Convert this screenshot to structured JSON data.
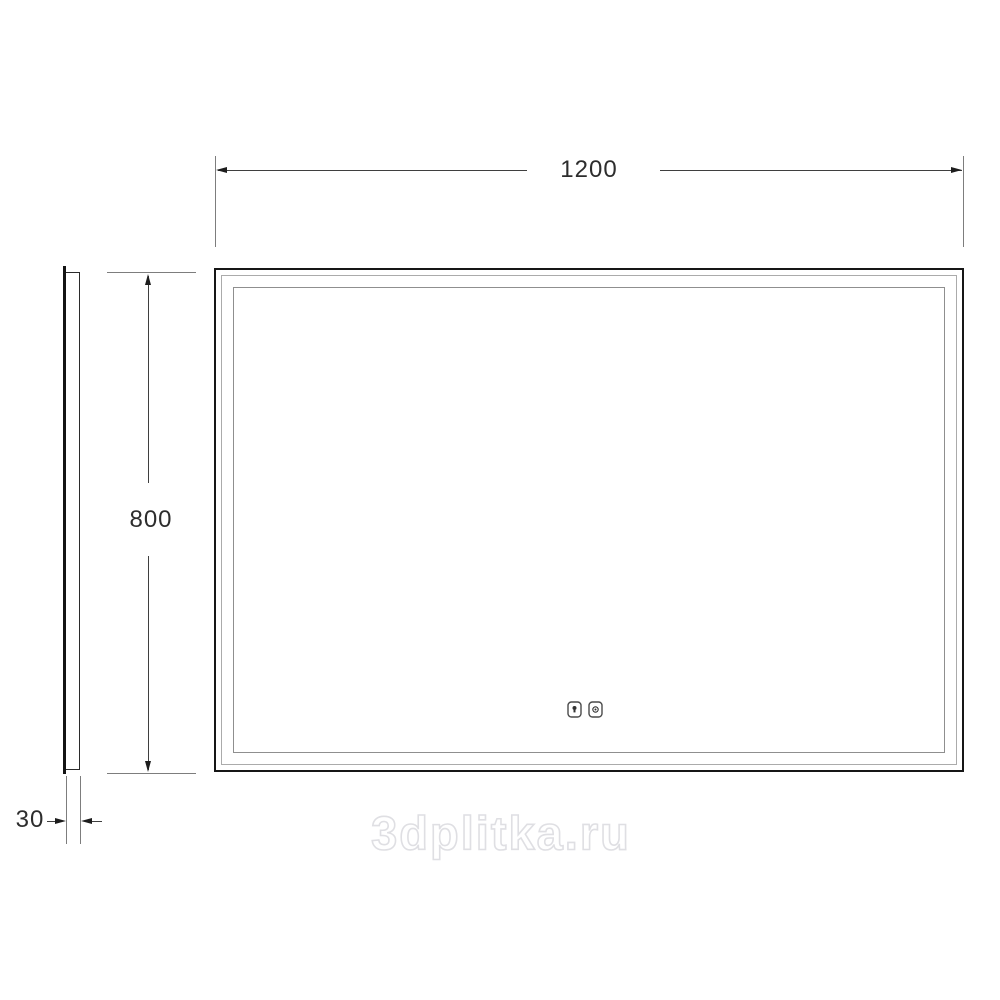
{
  "drawing": {
    "kind": "mirror-technical-drawing",
    "views": {
      "front": "front view of rectangular illuminated mirror with double inner light strip outline",
      "side": "thin side profile view"
    },
    "dimensions": {
      "width": {
        "value": "1200"
      },
      "height": {
        "value": "800"
      },
      "depth": {
        "value": "30"
      }
    },
    "sensors": {
      "left": "touch-light-sensor",
      "right": "touch-clock-sensor"
    },
    "colors": {
      "frame": "#161616",
      "inner_line_1": "#ababab",
      "inner_line_2": "#8f8f8f",
      "dimension_line": "#3f3f3f",
      "extension_line": "#7d7d7d",
      "label_text": "#2d2d2d",
      "watermark": "#dfdfe3",
      "background": "#ffffff"
    }
  },
  "watermark": {
    "text": "3dplitka.ru"
  }
}
